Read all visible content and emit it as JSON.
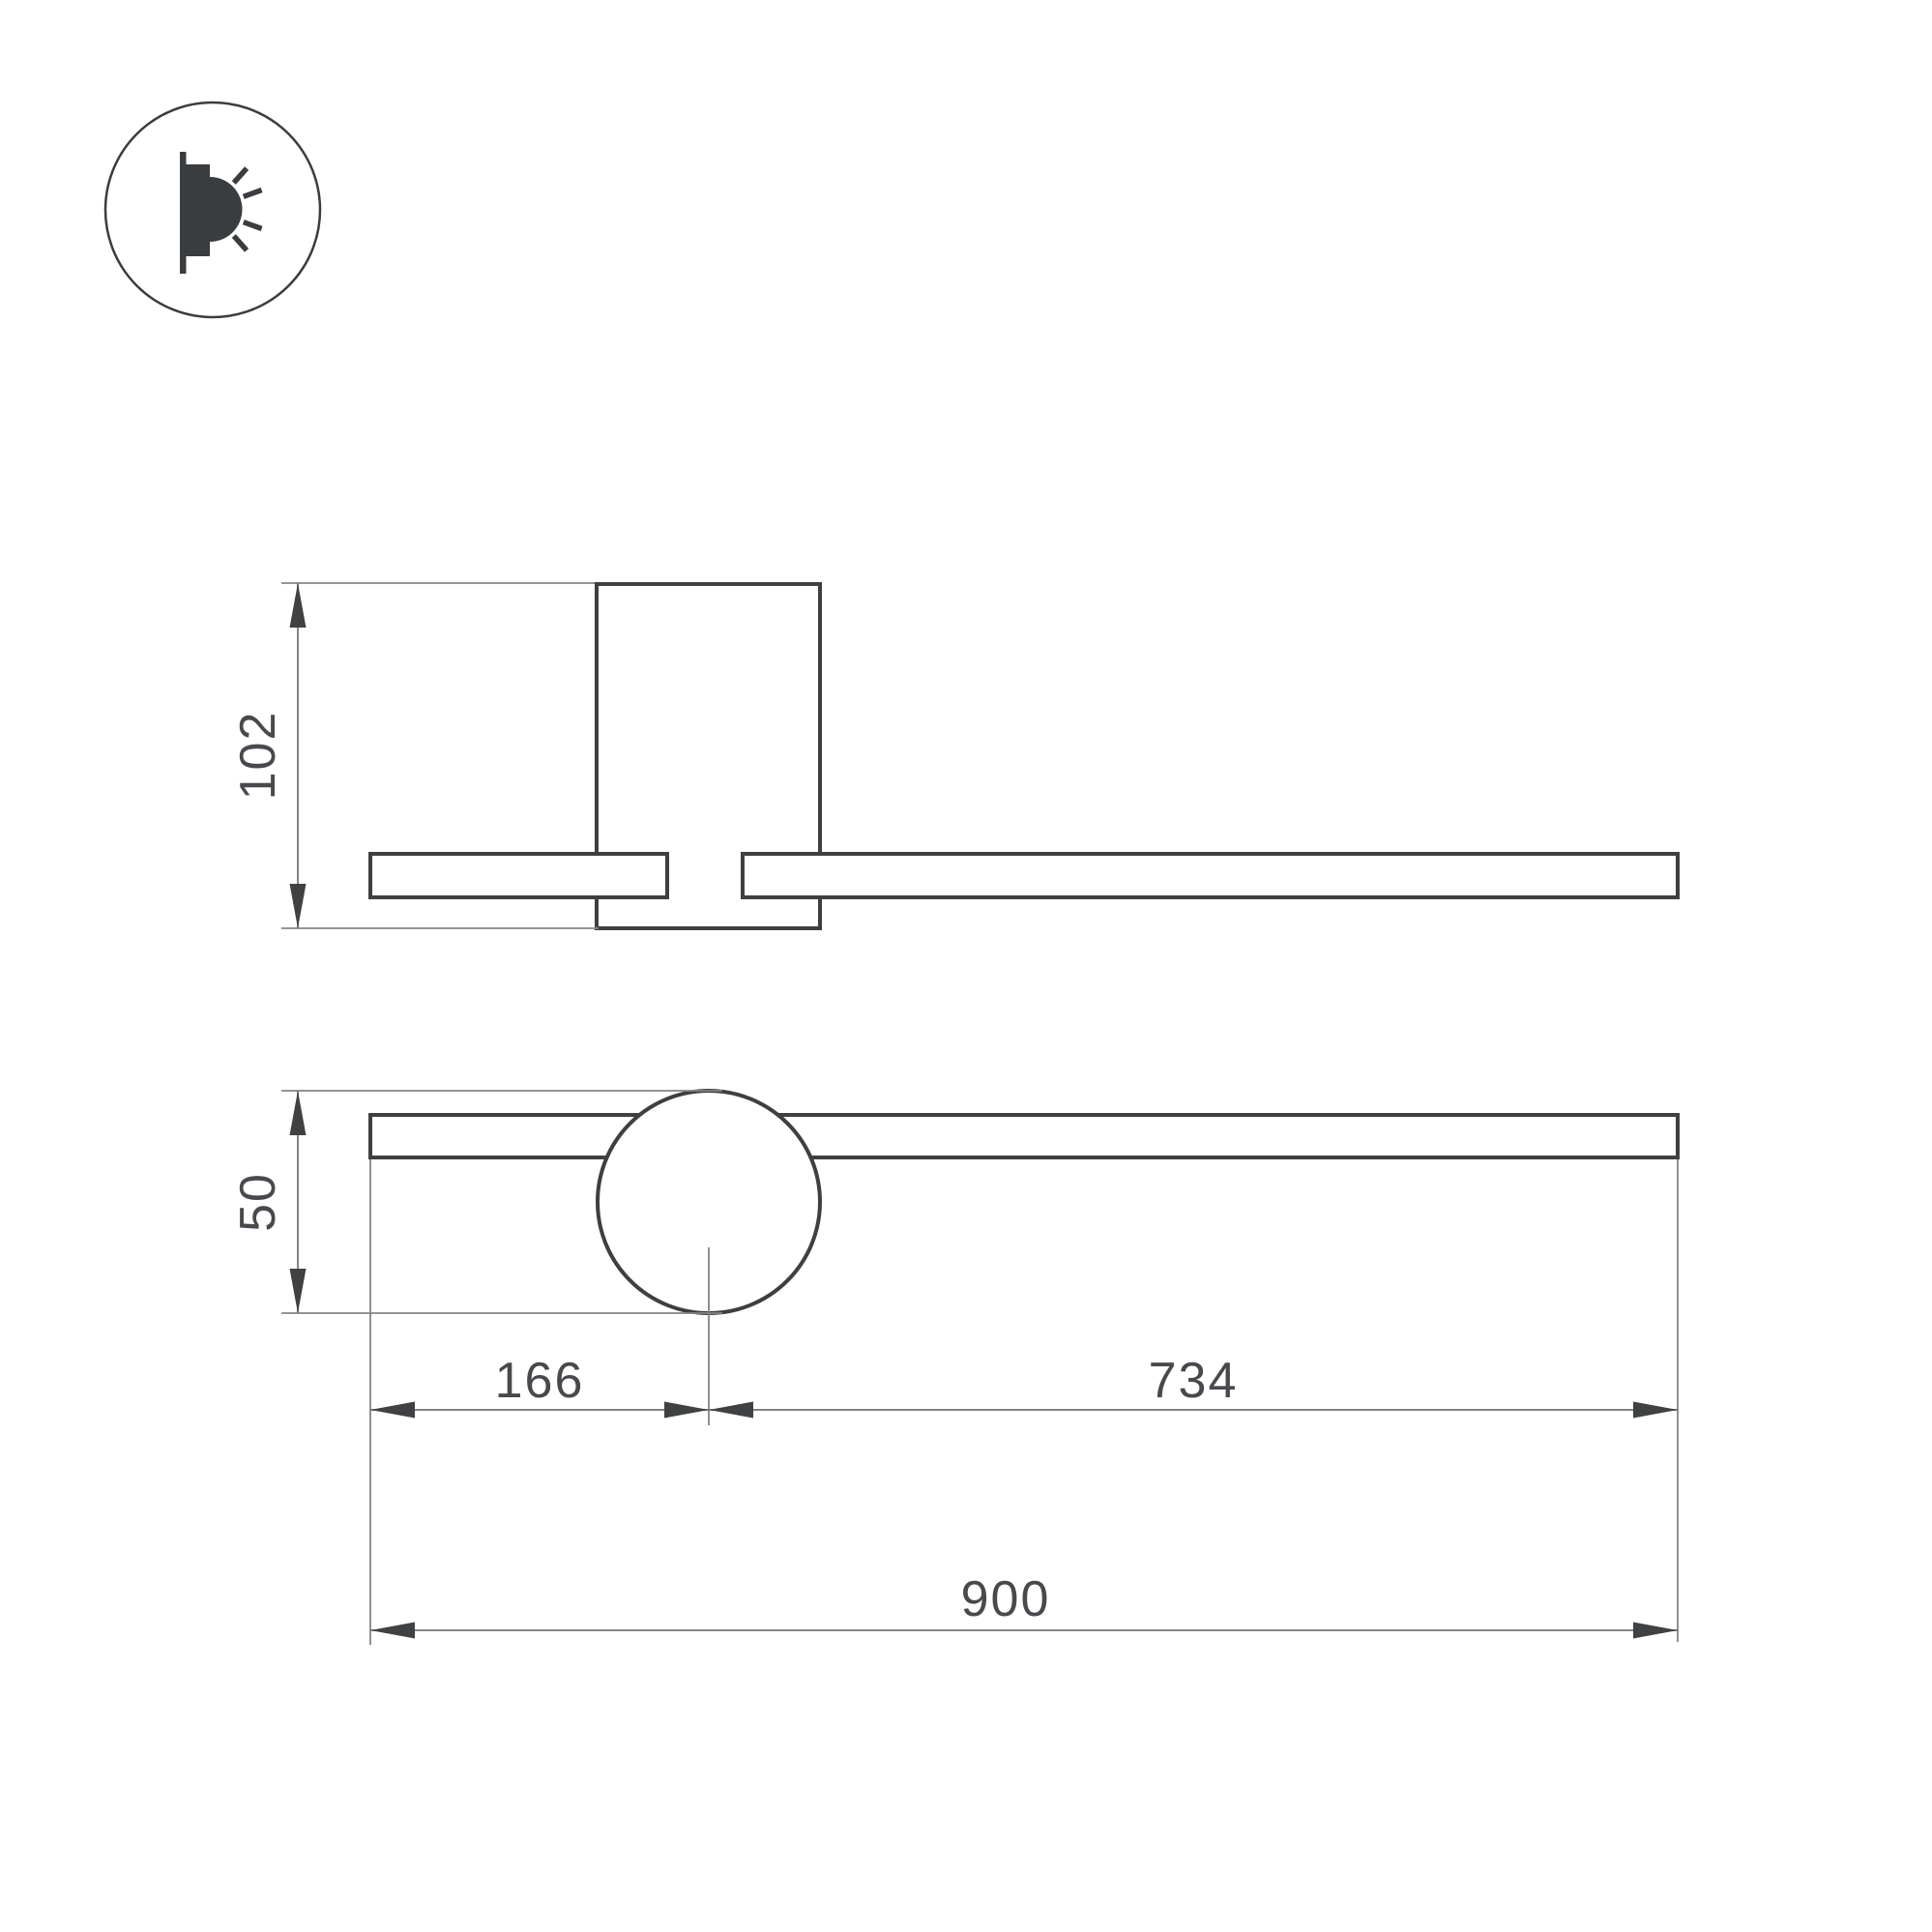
{
  "drawing": {
    "background": "#ffffff",
    "icon": {
      "name": "wall-light-icon"
    }
  },
  "colors": {
    "object_line": "#3f3f41",
    "dim_line": "#838486",
    "arrow": "#3f4143",
    "text": "#47494c",
    "icon": "#3a3d40"
  },
  "dimensions": {
    "side_height": "102",
    "front_joint_diameter": "50",
    "front_left_offset": "166",
    "front_right_span": "734",
    "front_total_length": "900"
  }
}
